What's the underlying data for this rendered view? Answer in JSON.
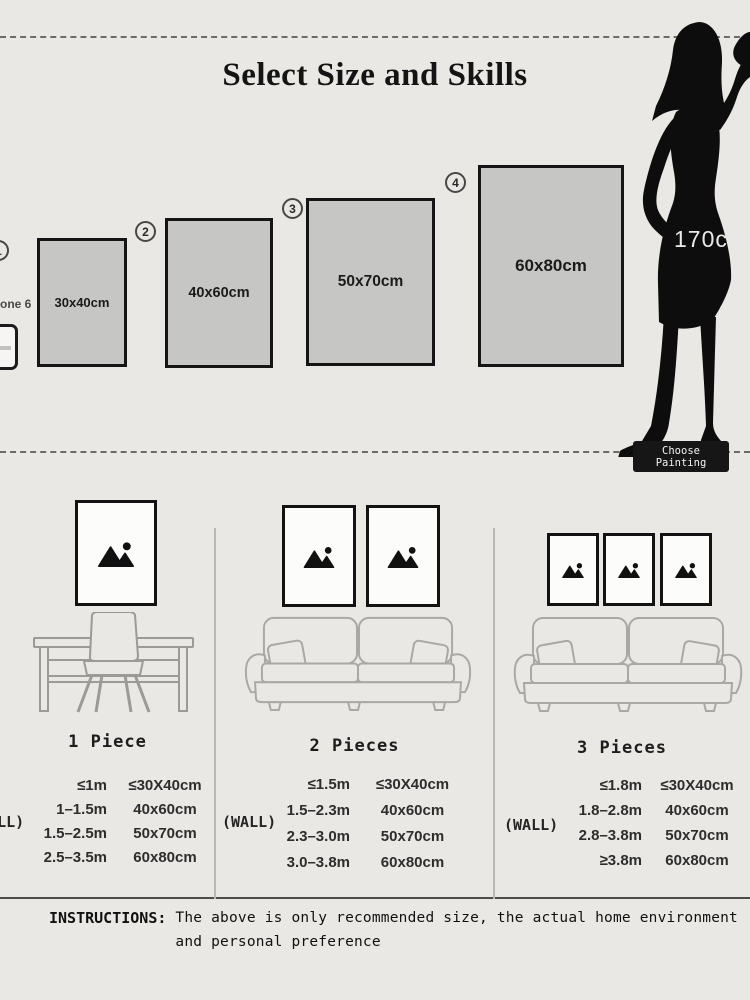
{
  "title": "Select Size and Skills",
  "top": {
    "phone_caption": "one 6",
    "height_label": "170cm",
    "choose_button_label": "Choose Painting",
    "sizes": [
      {
        "badge": "1",
        "label": "30x40cm"
      },
      {
        "badge": "2",
        "label": "40x60cm"
      },
      {
        "badge": "3",
        "label": "50x70cm"
      },
      {
        "badge": "4",
        "label": "60x80cm"
      }
    ]
  },
  "sections": [
    {
      "label": "1 Piece",
      "wall_label": "(WALL)",
      "rows": [
        {
          "distance": "≤1m",
          "size": "≤30X40cm"
        },
        {
          "distance": "1–1.5m",
          "size": "40x60cm"
        },
        {
          "distance": "1.5–2.5m",
          "size": "50x70cm"
        },
        {
          "distance": "2.5–3.5m",
          "size": "60x80cm"
        }
      ]
    },
    {
      "label": "2 Pieces",
      "wall_label": "(WALL)",
      "rows": [
        {
          "distance": "≤1.5m",
          "size": "≤30X40cm"
        },
        {
          "distance": "1.5–2.3m",
          "size": "40x60cm"
        },
        {
          "distance": "2.3–3.0m",
          "size": "50x70cm"
        },
        {
          "distance": "3.0–3.8m",
          "size": "60x80cm"
        }
      ]
    },
    {
      "label": "3 Pieces",
      "wall_label": "(WALL)",
      "rows": [
        {
          "distance": "≤1.8m",
          "size": "≤30X40cm"
        },
        {
          "distance": "1.8–2.8m",
          "size": "40x60cm"
        },
        {
          "distance": "2.8–3.8m",
          "size": "50x70cm"
        },
        {
          "distance": "≥3.8m",
          "size": "60x80cm"
        }
      ]
    }
  ],
  "instructions": {
    "label": "INSTRUCTIONS:",
    "line1": "The above is only recommended size, the actual home environment",
    "line2": "and personal preference"
  },
  "colors": {
    "background": "#e9e8e5",
    "swatch_fill": "#c6c6c4",
    "ink": "#151515",
    "line_gray": "#a8a6a3",
    "button_bg": "#161616",
    "button_text": "#f2f2f2",
    "height_text": "#e9e9e9"
  }
}
